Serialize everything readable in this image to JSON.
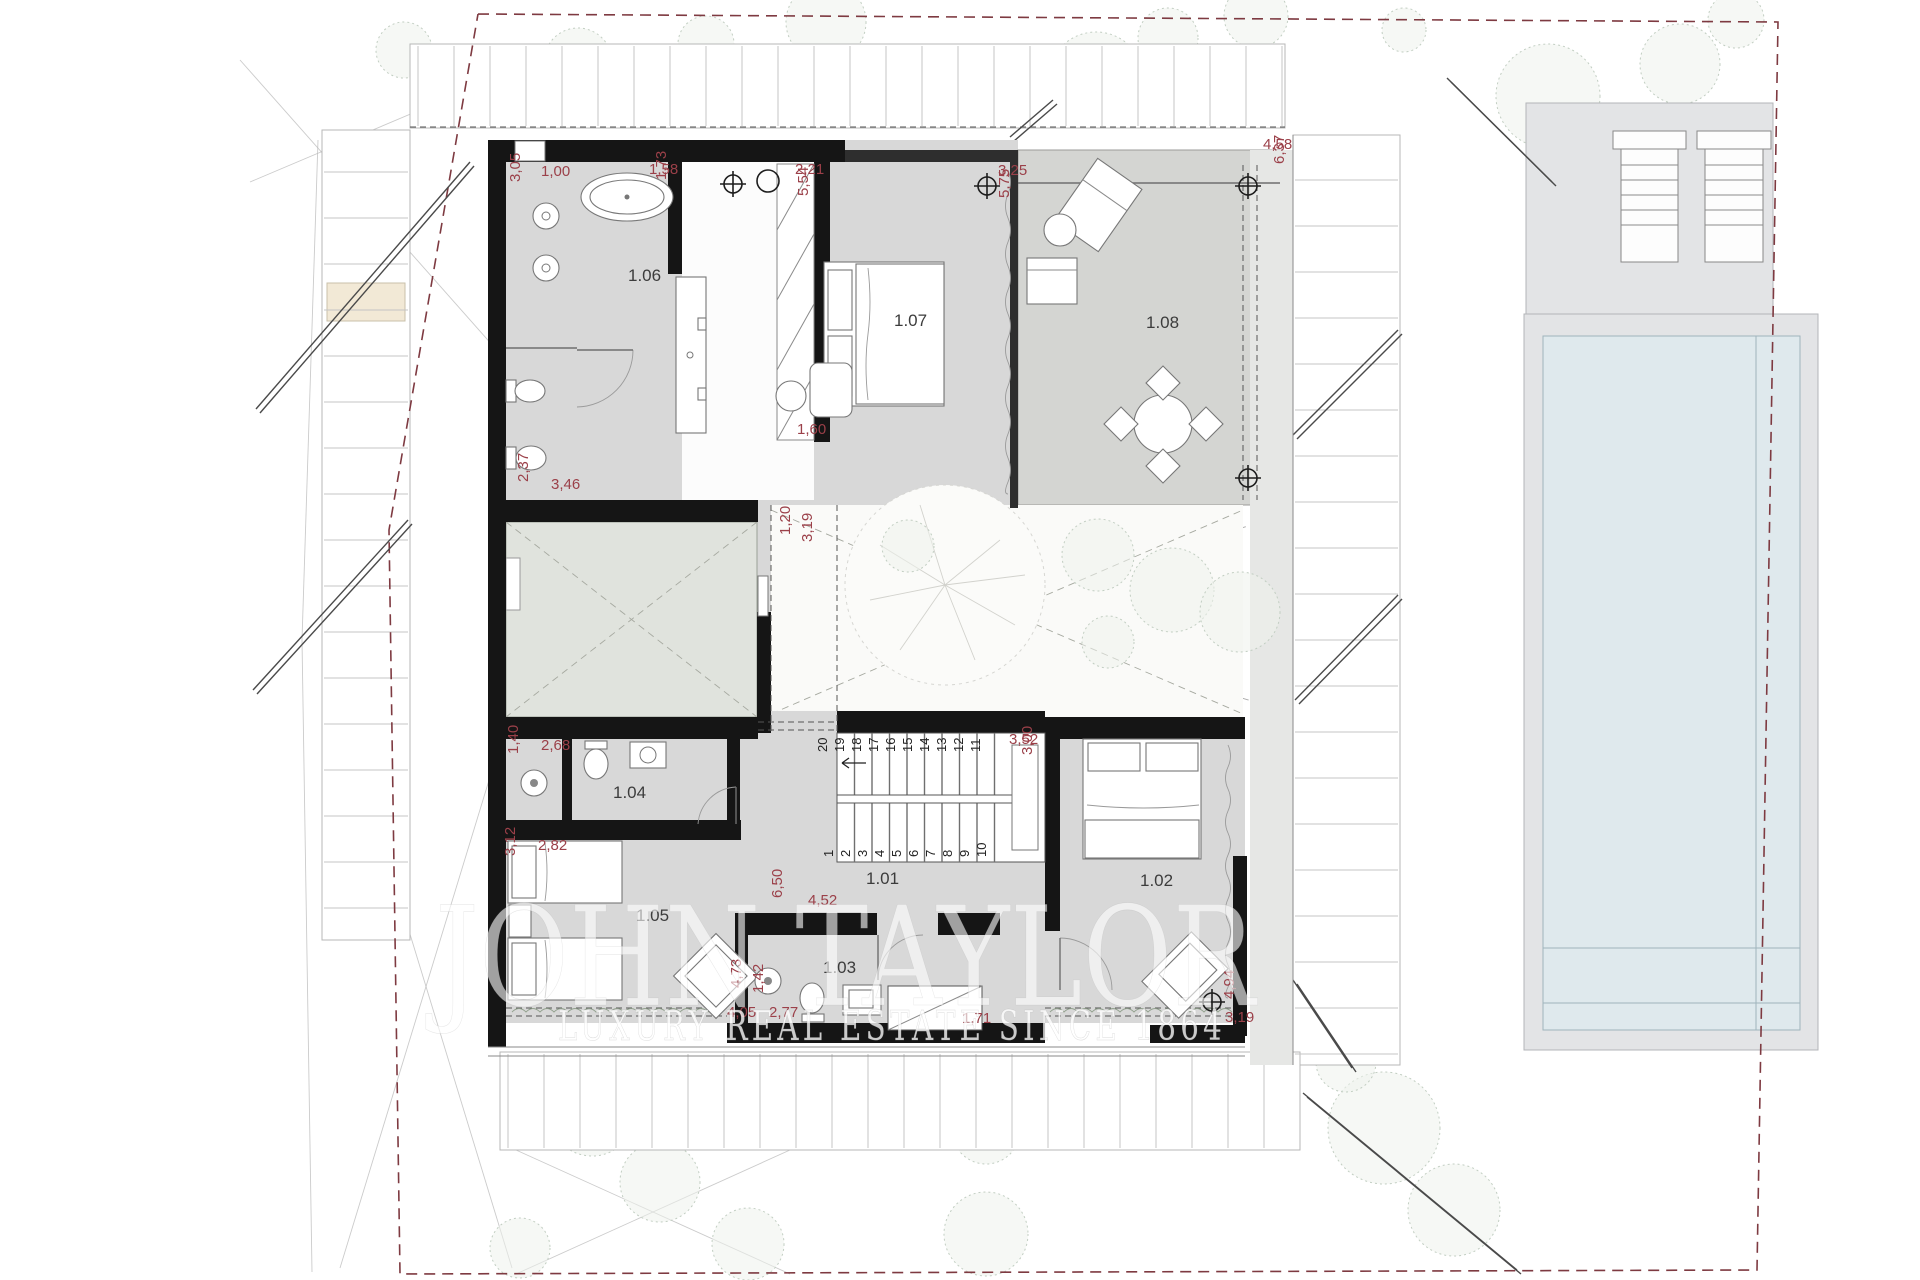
{
  "watermark": {
    "line1": "JOHN TAYLOR",
    "line2": "LUXURY REAL ESTATE SINCE 1864"
  },
  "rooms": [
    {
      "id": "1.01",
      "x": 866,
      "y": 884
    },
    {
      "id": "1.02",
      "x": 1140,
      "y": 886
    },
    {
      "id": "1.03",
      "x": 823,
      "y": 973
    },
    {
      "id": "1.04",
      "x": 613,
      "y": 798
    },
    {
      "id": "1.05",
      "x": 636,
      "y": 921
    },
    {
      "id": "1.06",
      "x": 628,
      "y": 281
    },
    {
      "id": "1.07",
      "x": 894,
      "y": 326
    },
    {
      "id": "1.08",
      "x": 1146,
      "y": 328
    }
  ],
  "dimensions": [
    {
      "v": "3,05",
      "x": 520,
      "y": 182,
      "rot": -90
    },
    {
      "v": "1,00",
      "x": 541,
      "y": 176,
      "rot": 0
    },
    {
      "v": "1,58",
      "x": 649,
      "y": 174,
      "rot": 0
    },
    {
      "v": "1,73",
      "x": 666,
      "y": 180,
      "rot": -90
    },
    {
      "v": "2,21",
      "x": 795,
      "y": 174,
      "rot": 0
    },
    {
      "v": "5,54",
      "x": 808,
      "y": 196,
      "rot": -90
    },
    {
      "v": "3,25",
      "x": 998,
      "y": 175,
      "rot": 0
    },
    {
      "v": "5,75",
      "x": 1009,
      "y": 198,
      "rot": -90
    },
    {
      "v": "4,58",
      "x": 1263,
      "y": 149,
      "rot": 0
    },
    {
      "v": "6,37",
      "x": 1284,
      "y": 164,
      "rot": -90
    },
    {
      "v": "2,37",
      "x": 528,
      "y": 482,
      "rot": -90
    },
    {
      "v": "3,46",
      "x": 551,
      "y": 489,
      "rot": 0
    },
    {
      "v": "1,20",
      "x": 790,
      "y": 535,
      "rot": -90
    },
    {
      "v": "3,19",
      "x": 812,
      "y": 542,
      "rot": -90
    },
    {
      "v": "1,60",
      "x": 797,
      "y": 434,
      "rot": 0
    },
    {
      "v": "1,40",
      "x": 518,
      "y": 754,
      "rot": -90
    },
    {
      "v": "2,68",
      "x": 541,
      "y": 750,
      "rot": 0
    },
    {
      "v": "3,12",
      "x": 515,
      "y": 856,
      "rot": -90
    },
    {
      "v": "2,82",
      "x": 538,
      "y": 850,
      "rot": 0
    },
    {
      "v": "6,50",
      "x": 782,
      "y": 898,
      "rot": -90
    },
    {
      "v": "4,52",
      "x": 808,
      "y": 905,
      "rot": 0
    },
    {
      "v": "4,73",
      "x": 741,
      "y": 988,
      "rot": -90
    },
    {
      "v": "4,05",
      "x": 727,
      "y": 1017,
      "rot": 0
    },
    {
      "v": "1,42",
      "x": 763,
      "y": 993,
      "rot": -90
    },
    {
      "v": "2,77",
      "x": 769,
      "y": 1017,
      "rot": 0
    },
    {
      "v": "1,71",
      "x": 962,
      "y": 1023,
      "rot": 0
    },
    {
      "v": "3,52",
      "x": 1009,
      "y": 744,
      "rot": 0
    },
    {
      "v": "3,00",
      "x": 1032,
      "y": 755,
      "rot": -90
    },
    {
      "v": "4,94",
      "x": 1234,
      "y": 999,
      "rot": -90
    },
    {
      "v": "3,19",
      "x": 1225,
      "y": 1022,
      "rot": 0
    }
  ],
  "stairs": {
    "upper_row": [
      "20",
      "19",
      "18",
      "17",
      "16",
      "15",
      "14",
      "13",
      "12",
      "11"
    ],
    "lower_row": [
      "1",
      "2",
      "3",
      "4",
      "5",
      "6",
      "7",
      "8",
      "9",
      "10"
    ]
  },
  "markers": [
    {
      "type": "crosshair",
      "x": 733,
      "y": 184
    },
    {
      "type": "crosshair",
      "x": 987,
      "y": 186
    },
    {
      "type": "crosshair",
      "x": 1248,
      "y": 186
    },
    {
      "type": "crosshair",
      "x": 1248,
      "y": 478
    },
    {
      "type": "crosshair",
      "x": 1212,
      "y": 1002
    },
    {
      "type": "circle",
      "x": 768,
      "y": 181
    }
  ],
  "colors": {
    "wall": "#151515",
    "dimension_text": "#9b4049",
    "room_fill": "#d8d8d8",
    "terrace_fill": "#d4d5d2",
    "patio_fill": "#e0e3dd",
    "pool_water": "#dfe9ed",
    "deck_fill": "#e4e5e7",
    "boundary": "#7e3a41",
    "vegetation": "#c2cec2"
  }
}
